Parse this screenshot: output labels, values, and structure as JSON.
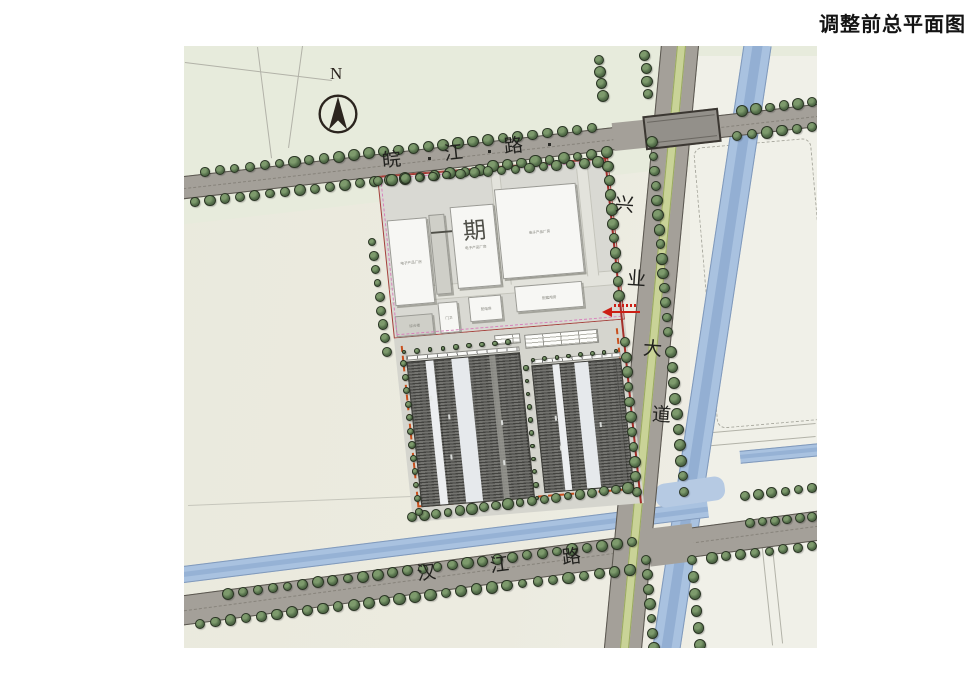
{
  "title": "调整前总平面图",
  "compass": {
    "label": "N"
  },
  "roads": {
    "wanjiang": {
      "name": "皖江路",
      "chars": [
        "皖",
        "江",
        "路"
      ]
    },
    "xingye": {
      "name": "兴业大道",
      "chars": [
        "兴",
        "业",
        "大",
        "道"
      ]
    },
    "hanjiang": {
      "name": "汉江路",
      "chars": [
        "汉",
        "江",
        "路"
      ]
    }
  },
  "site": {
    "phase1": {
      "label": "一期",
      "buildings": [
        "电子产品厂房",
        "电子产品厂房",
        "电子产品厂房",
        "配套用房",
        "综合楼",
        "门卫",
        "配电房"
      ]
    }
  },
  "colors": {
    "road": "#a4a099",
    "water": "#a9c2e0",
    "water_deep": "#8fabd0",
    "tree_dark": "#3c4f35",
    "tree_mid": "#55704b",
    "tree_light": "#7d9a6c",
    "phase1_building": "#f7f7f4",
    "phase2_roof": "#6e6e6a",
    "boundary_pink": "#d883bc",
    "boundary_red": "#a5302a",
    "boundary_orange": "#c8501e",
    "median_green": "#c9d397"
  }
}
